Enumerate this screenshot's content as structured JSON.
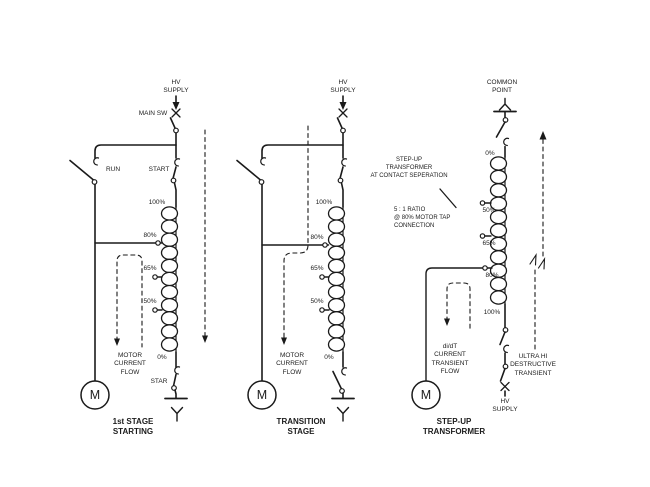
{
  "stage1": {
    "hv_supply": "HV\nSUPPLY",
    "main_sw": "MAIN SW",
    "run": "RUN",
    "start": "START",
    "taps": [
      "100%",
      "80%",
      "65%",
      "50%",
      "0%"
    ],
    "star": "STAR",
    "motor_label": "M",
    "flow": "MOTOR\nCURRENT\nFLOW",
    "caption": "1st STAGE\nSTARTING"
  },
  "stage2": {
    "hv_supply": "HV\nSUPPLY",
    "taps": [
      "100%",
      "80%",
      "65%",
      "50%",
      "0%"
    ],
    "motor_label": "M",
    "flow": "MOTOR\nCURRENT\nFLOW",
    "caption": "TRANSITION\nSTAGE"
  },
  "stage3": {
    "common_point": "COMMON\nPOINT",
    "taps": [
      "0%",
      "50%",
      "65%",
      "80%",
      "100%"
    ],
    "motor_label": "M",
    "flow": "di/dT\nCURRENT\nTRANSIENT\nFLOW",
    "ultra_hi": "ULTRA HI\nDESTRUCTIVE\nTRANSIENT",
    "hv_supply": "HV\nSUPPLY",
    "caption": "STEP-UP\nTRANSFORMER",
    "note_transformer": "STEP-UP\nTRANSFORMER\nAT CONTACT SEPERATION",
    "note_ratio": "5 : 1 RATIO\n@ 80% MOTOR TAP\nCONNECTION"
  },
  "colors": {
    "line": "#1a1a1a",
    "background": "#ffffff"
  }
}
